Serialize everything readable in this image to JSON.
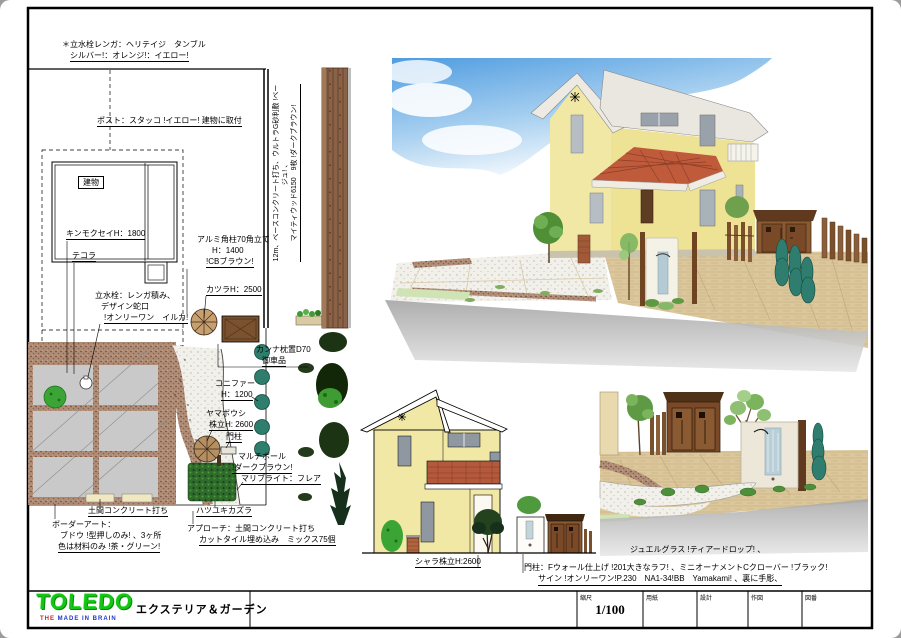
{
  "plan": {
    "annotations": {
      "note_l1": "＊立水栓レンガ：ヘリテイジ　タンブル",
      "note_l2": "シルバー!：オレンジ!：イエロー!",
      "post": "ポスト：スタッコ !イエロー! 建物に取付",
      "building": "建物",
      "kinmokusei": "キンモクセイH：1800",
      "tekora": "テコラ",
      "tap_l1": "立水栓：レンガ積み、",
      "tap_l2": "デザイン蛇口",
      "tap_l3": "!オンリーワン　イルカ!",
      "alumi_l1": "アルミ角柱70角立て",
      "alumi_l2": "H：1400",
      "alumi_l3": "!CBブラウン!",
      "katsura": "カツラH：2500",
      "kanna_l1": "カンナ枕置D70",
      "kanna_l2": "御車品",
      "conifer_l1": "コニファー",
      "conifer_l2": "H：1200",
      "yamaboushi_l1": "ヤマボウシ",
      "yamaboushi_l2": "株立H: 2600",
      "monchu": "門柱",
      "multipole_l1": "マルチポール",
      "multipole_l2": "!ダークブラウン!",
      "maribulight": "マリブライト：フレア",
      "hatsuyuki": "ハツユキカズラ",
      "doma": "土間コンクリート打ち",
      "border_l1": "ボーダーアート：",
      "border_l2": "ブドウ !型押しのみ! 、3ヶ所",
      "border_l3": "色は材料のみ !茶・グリーン!",
      "approach_l1": "アプローチ：土間コンクリート打ち",
      "approach_l2": "カットタイル埋め込み　ミックス75個",
      "fence_v_l1": "12m、ベースコンクリート打ち、ウルトラG砂利敷 !ベージュ! 、",
      "fence_v_l2": "マイティウッド6150　9枚 !ダークブラウン!"
    }
  },
  "elevation": {
    "shara_label": "シャラ株立H:2600"
  },
  "captions": {
    "jewel": "ジュエルグラス !ティアードロップ! 、",
    "gate_l1": "門柱：Fウォール仕上げ !201大きなラフ! 、ミニオーナメントCクローバー !ブラック!",
    "gate_l2": "サイン !オンリーワン!P.230　NA1-34!BB　Yamakami! 、裏に手彫、"
  },
  "title_block": {
    "logo": "TOLEDO",
    "tagline_1": "THE",
    "tagline_2": "MADE IN BRAIN",
    "department": "エクステリア＆ガーデン",
    "scale_label": "縮尺",
    "scale_value": "1/100",
    "paper_label": "用紙",
    "design_label": "設計",
    "draft_label": "作図",
    "number_label": "図番"
  },
  "colors": {
    "wall_yellow": "#f2e8a6",
    "roof_tile_red": "#bf5a3a",
    "roof_white": "#eceae2",
    "wood_brown": "#7a4a28",
    "soil_brown": "#b08d77",
    "conifer_teal": "#2e7d6e",
    "plant_green": "#3f9c33",
    "sky_blue": "#5aa3e0",
    "logo_green": "#16c416",
    "tagline_red": "#cc2222",
    "tagline_blue": "#2233cc"
  }
}
